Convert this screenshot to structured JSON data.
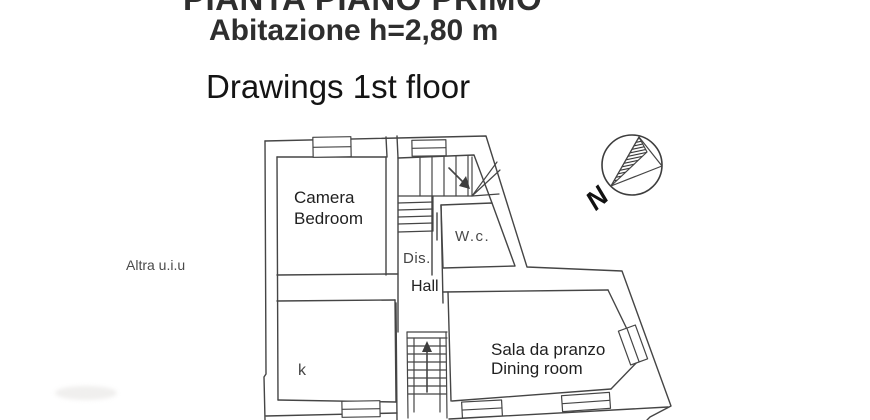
{
  "header": {
    "title": "PIANTA PIANO PRIMO",
    "subtitle": "Abitazione h=2,80 m",
    "caption": "Drawings 1st floor"
  },
  "plan": {
    "outside_note": "Altra u.i.u",
    "rooms": {
      "bedroom": {
        "it": "Camera",
        "en": "Bedroom"
      },
      "wc": {
        "label": "W.c."
      },
      "dis": {
        "label": "Dis."
      },
      "hall": {
        "label": "Hall"
      },
      "kitchen": {
        "label": "k"
      },
      "dining": {
        "it": "Sala da pranzo",
        "en": "Dining room"
      }
    },
    "compass": {
      "north_label": "N"
    }
  },
  "colors": {
    "line": "#454545",
    "scan_text": "#4a4a4a",
    "ink_text": "#1a1a1a"
  }
}
